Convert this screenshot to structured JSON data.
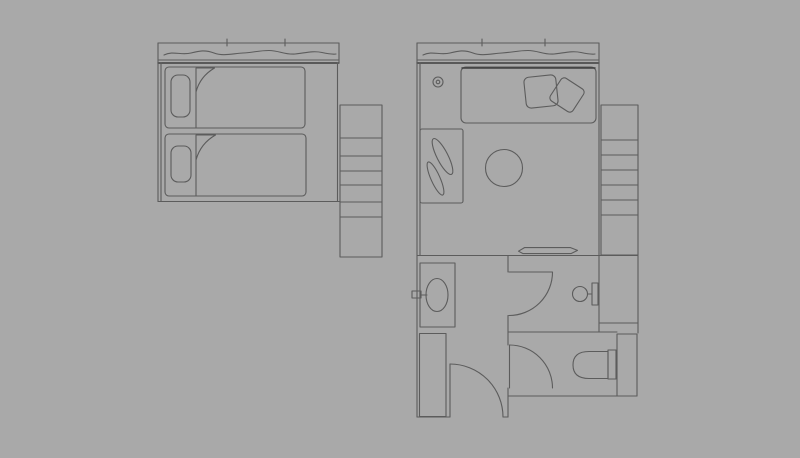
{
  "canvas": {
    "width": 800,
    "height": 458,
    "background": "#a9a9a9",
    "line_color": "#5c5c5c",
    "line_dark_color": "#3f3f3f"
  },
  "drawing": {
    "groups": [
      {
        "name": "twin-room-plan",
        "shapes": [
          {
            "t": "line",
            "n": "window-top-line",
            "x1": 158,
            "y1": 43,
            "x2": 339,
            "y2": 43
          },
          {
            "t": "line",
            "n": "window-tick-1",
            "x1": 227,
            "y1": 39,
            "x2": 227,
            "y2": 46
          },
          {
            "t": "line",
            "n": "window-tick-2",
            "x1": 285,
            "y1": 39,
            "x2": 285,
            "y2": 46
          },
          {
            "t": "path",
            "n": "curtain-line",
            "d": "M164,55 C173,50.5 181,55.5 191,53 C199,51 205,49.5 214,53 C223,56.5 233,53.5 243,53 C253,52.5 259,50.5 269,50.5 C279,50.5 285,55 295,54 C305,53 313,50.5 322,52.5 C329,54 333,54.5 336,54"
          },
          {
            "t": "line",
            "n": "window-sill-line",
            "x1": 158,
            "y1": 60,
            "x2": 339,
            "y2": 60
          },
          {
            "t": "line",
            "n": "window-sill-line-2",
            "x1": 158,
            "y1": 63,
            "x2": 339,
            "y2": 63,
            "dark": true
          },
          {
            "t": "line",
            "n": "window-end-cap",
            "x1": 339,
            "y1": 43,
            "x2": 339,
            "y2": 63
          },
          {
            "t": "line",
            "n": "wall-left",
            "x1": 158,
            "y1": 43,
            "x2": 158,
            "y2": 201.5
          },
          {
            "t": "line",
            "n": "wall-left-inner",
            "x1": 161,
            "y1": 63,
            "x2": 161,
            "y2": 201
          },
          {
            "t": "line",
            "n": "wall-right",
            "x1": 337.5,
            "y1": 63,
            "x2": 337.5,
            "y2": 201.5
          },
          {
            "t": "line",
            "n": "wall-bottom",
            "x1": 158,
            "y1": 201.5,
            "x2": 340,
            "y2": 201.5
          },
          {
            "t": "rect",
            "n": "bed-1",
            "x": 165,
            "y": 67,
            "w": 140,
            "h": 61,
            "rx": 4
          },
          {
            "t": "rect",
            "n": "bed-1-pillow",
            "x": 171,
            "y": 75,
            "w": 19,
            "h": 42,
            "rx": 7
          },
          {
            "t": "line",
            "n": "bed-1-blanket-edge",
            "x1": 196,
            "y1": 92,
            "x2": 196,
            "y2": 128
          },
          {
            "t": "path",
            "n": "bed-1-sheet-fold",
            "d": "M196,92 L196,68 L214.5,68 Q200,76.5 196,92 Z"
          },
          {
            "t": "rect",
            "n": "bed-2",
            "x": 165,
            "y": 134,
            "w": 141,
            "h": 62,
            "rx": 4
          },
          {
            "t": "rect",
            "n": "bed-2-pillow",
            "x": 171,
            "y": 146,
            "w": 20,
            "h": 36,
            "rx": 7
          },
          {
            "t": "line",
            "n": "bed-2-blanket-edge",
            "x1": 196,
            "y1": 160,
            "x2": 196,
            "y2": 196
          },
          {
            "t": "path",
            "n": "bed-2-sheet-fold",
            "d": "M196,160 L196,135 L215.5,135 Q200.5,143.5 196,160 Z"
          },
          {
            "t": "rect",
            "n": "staircase",
            "x": 340,
            "y": 105,
            "w": 42,
            "h": 152
          },
          {
            "t": "line",
            "n": "stair-step-1",
            "x1": 340,
            "y1": 138,
            "x2": 382,
            "y2": 138
          },
          {
            "t": "line",
            "n": "stair-step-2",
            "x1": 340,
            "y1": 156,
            "x2": 382,
            "y2": 156
          },
          {
            "t": "line",
            "n": "stair-step-3",
            "x1": 340,
            "y1": 171,
            "x2": 382,
            "y2": 171
          },
          {
            "t": "line",
            "n": "stair-step-4",
            "x1": 340,
            "y1": 185,
            "x2": 382,
            "y2": 185
          },
          {
            "t": "line",
            "n": "stair-step-5",
            "x1": 340,
            "y1": 202,
            "x2": 382,
            "y2": 202
          },
          {
            "t": "line",
            "n": "stair-step-6",
            "x1": 340,
            "y1": 217,
            "x2": 382,
            "y2": 217
          }
        ]
      },
      {
        "name": "suite-room-plan",
        "shapes": [
          {
            "t": "line",
            "n": "window-top-line",
            "x1": 417,
            "y1": 43,
            "x2": 599,
            "y2": 43
          },
          {
            "t": "line",
            "n": "window-tick-1",
            "x1": 482,
            "y1": 39,
            "x2": 482,
            "y2": 46
          },
          {
            "t": "line",
            "n": "window-tick-2",
            "x1": 545,
            "y1": 39,
            "x2": 545,
            "y2": 46
          },
          {
            "t": "path",
            "n": "curtain-line",
            "d": "M164,55 C173,50.5 181,55.5 191,53 C199,51 205,49.5 214,53 C223,56.5 233,53.5 243,53 C253,52.5 259,50.5 269,50.5 C279,50.5 285,55 295,54 C305,53 313,50.5 322,52.5 C329,54 333,54.5 336,54",
            "tf": "translate(259,0)"
          },
          {
            "t": "line",
            "n": "window-sill-line",
            "x1": 417,
            "y1": 60,
            "x2": 599,
            "y2": 60
          },
          {
            "t": "line",
            "n": "window-sill-line-2",
            "x1": 417,
            "y1": 63,
            "x2": 599,
            "y2": 63,
            "dark": true
          },
          {
            "t": "line",
            "n": "wall-left",
            "x1": 417,
            "y1": 43,
            "x2": 417,
            "y2": 417
          },
          {
            "t": "line",
            "n": "wall-left-inner",
            "x1": 420,
            "y1": 63,
            "x2": 420,
            "y2": 255
          },
          {
            "t": "line",
            "n": "wall-right-upper",
            "x1": 599,
            "y1": 43,
            "x2": 599,
            "y2": 255.5
          },
          {
            "t": "line",
            "n": "wall-bottom-main",
            "x1": 417,
            "y1": 255.5,
            "x2": 638,
            "y2": 255.5
          },
          {
            "t": "rect",
            "n": "bed",
            "x": 461,
            "y": 67,
            "w": 135,
            "h": 56,
            "rx": 5
          },
          {
            "t": "line",
            "n": "bed-head-line",
            "x1": 462,
            "y1": 68,
            "x2": 595,
            "y2": 68,
            "dark": true
          },
          {
            "t": "rect",
            "n": "bed-pillow-1",
            "x": 525,
            "y": 76,
            "w": 32,
            "h": 31,
            "rx": 5,
            "tf": "rotate(-6 541 91.5)"
          },
          {
            "t": "rect",
            "n": "bed-pillow-2",
            "x": 553.5,
            "y": 81.5,
            "w": 27,
            "h": 27,
            "rx": 4,
            "tf": "rotate(33 567 95)"
          },
          {
            "t": "circle",
            "n": "wall-lamp",
            "cx": 438,
            "cy": 82,
            "r": 5
          },
          {
            "t": "circle",
            "n": "wall-lamp-inner",
            "cx": 438,
            "cy": 82,
            "r": 1.8
          },
          {
            "t": "rect",
            "n": "planter-box",
            "x": 420,
            "y": 129,
            "w": 43,
            "h": 74,
            "rx": 2
          },
          {
            "t": "ellipse",
            "n": "plant-leaf-1",
            "cx": 442.5,
            "cy": 156.5,
            "rx": 5.5,
            "ry": 20,
            "tf": "rotate(-27 442.5 156.5)"
          },
          {
            "t": "ellipse",
            "n": "plant-leaf-2",
            "cx": 435.5,
            "cy": 178.5,
            "rx": 4.5,
            "ry": 18,
            "tf": "rotate(-24 435.5 178.5)"
          },
          {
            "t": "circle",
            "n": "round-table",
            "cx": 504,
            "cy": 168,
            "r": 18.5
          },
          {
            "t": "path",
            "n": "luggage-tray",
            "d": "M518.5,251.2 L524.5,247.6 L570.5,247.6 L577.5,250.4 L571,253.6 L523,253.6 Z"
          },
          {
            "t": "rect",
            "n": "staircase",
            "x": 601,
            "y": 105,
            "w": 37,
            "h": 150
          },
          {
            "t": "line",
            "n": "stair-step-1",
            "x1": 601,
            "y1": 140,
            "x2": 638,
            "y2": 140
          },
          {
            "t": "line",
            "n": "stair-step-2",
            "x1": 601,
            "y1": 155,
            "x2": 638,
            "y2": 155
          },
          {
            "t": "line",
            "n": "stair-step-3",
            "x1": 601,
            "y1": 170,
            "x2": 638,
            "y2": 170
          },
          {
            "t": "line",
            "n": "stair-step-4",
            "x1": 601,
            "y1": 185,
            "x2": 638,
            "y2": 185
          },
          {
            "t": "line",
            "n": "stair-step-5",
            "x1": 601,
            "y1": 200,
            "x2": 638,
            "y2": 200
          },
          {
            "t": "line",
            "n": "stair-step-6",
            "x1": 601,
            "y1": 215,
            "x2": 638,
            "y2": 215
          },
          {
            "t": "line",
            "n": "shaft-wall-right",
            "x1": 638,
            "y1": 255.5,
            "x2": 638,
            "y2": 333
          },
          {
            "t": "line",
            "n": "shaft-divider",
            "x1": 599,
            "y1": 323,
            "x2": 638,
            "y2": 323
          },
          {
            "t": "line",
            "n": "shower-right-wall",
            "x1": 599,
            "y1": 255.5,
            "x2": 599,
            "y2": 332
          },
          {
            "t": "line",
            "n": "wc-top-wall",
            "x1": 508,
            "y1": 332,
            "x2": 617,
            "y2": 332
          },
          {
            "t": "rect",
            "n": "corner-shaft",
            "x": 617,
            "y": 334,
            "w": 20,
            "h": 62
          },
          {
            "t": "line",
            "n": "wc-bottom-wall",
            "x1": 508,
            "y1": 396,
            "x2": 637,
            "y2": 396
          },
          {
            "t": "line",
            "n": "partition-wall-a",
            "x1": 508,
            "y1": 255.5,
            "x2": 508,
            "y2": 272
          },
          {
            "t": "line",
            "n": "partition-wall-b",
            "x1": 508,
            "y1": 315.5,
            "x2": 508,
            "y2": 345
          },
          {
            "t": "line",
            "n": "partition-wall-c",
            "x1": 508,
            "y1": 388,
            "x2": 508,
            "y2": 417
          },
          {
            "t": "line",
            "n": "hall-bottom-wall-a",
            "x1": 417,
            "y1": 417,
            "x2": 450,
            "y2": 417
          },
          {
            "t": "line",
            "n": "hall-bottom-wall-b",
            "x1": 503,
            "y1": 417,
            "x2": 508,
            "y2": 417
          },
          {
            "t": "rect",
            "n": "sink-counter",
            "x": 420,
            "y": 263,
            "w": 35,
            "h": 64
          },
          {
            "t": "ellipse",
            "n": "sink-basin",
            "cx": 437,
            "cy": 295,
            "rx": 11,
            "ry": 16.5
          },
          {
            "t": "rect",
            "n": "sink-faucet",
            "x": 412,
            "y": 291,
            "w": 9,
            "h": 7
          },
          {
            "t": "line",
            "n": "sink-faucet-line",
            "x1": 421,
            "y1": 295,
            "x2": 427,
            "y2": 295
          },
          {
            "t": "line",
            "n": "shower-door-leaf",
            "x1": 509,
            "y1": 272,
            "x2": 552,
            "y2": 272
          },
          {
            "t": "path",
            "n": "shower-door-arc",
            "d": "M552.5,272 A43.5,43.5 0 0 1 509,315.5"
          },
          {
            "t": "circle",
            "n": "washbasin",
            "cx": 580,
            "cy": 294,
            "r": 7.5
          },
          {
            "t": "line",
            "n": "washbasin-arm",
            "x1": 587.5,
            "y1": 294,
            "x2": 592,
            "y2": 294
          },
          {
            "t": "rect",
            "n": "washbasin-bracket",
            "x": 592,
            "y": 283,
            "w": 6,
            "h": 22
          },
          {
            "t": "line",
            "n": "wc-door-leaf",
            "x1": 509.5,
            "y1": 345,
            "x2": 509.5,
            "y2": 388
          },
          {
            "t": "path",
            "n": "wc-door-arc",
            "d": "M509.5,345 A43,43 0 0 1 552.5,388"
          },
          {
            "t": "path",
            "n": "toilet-bowl",
            "d": "M608,351.5 L589,351.5 Q573,351.5 573,365 Q573,378.5 589,378.5 L608,378.5 Z"
          },
          {
            "t": "rect",
            "n": "toilet-tank",
            "x": 608,
            "y": 350,
            "w": 8,
            "h": 29
          },
          {
            "t": "rect",
            "n": "wardrobe",
            "x": 419.5,
            "y": 333.5,
            "w": 26.5,
            "h": 83
          },
          {
            "t": "line",
            "n": "entry-door-leaf",
            "x1": 450,
            "y1": 364,
            "x2": 450,
            "y2": 417
          },
          {
            "t": "path",
            "n": "entry-door-arc",
            "d": "M450,364 A53,53 0 0 1 503,417"
          }
        ]
      }
    ]
  }
}
